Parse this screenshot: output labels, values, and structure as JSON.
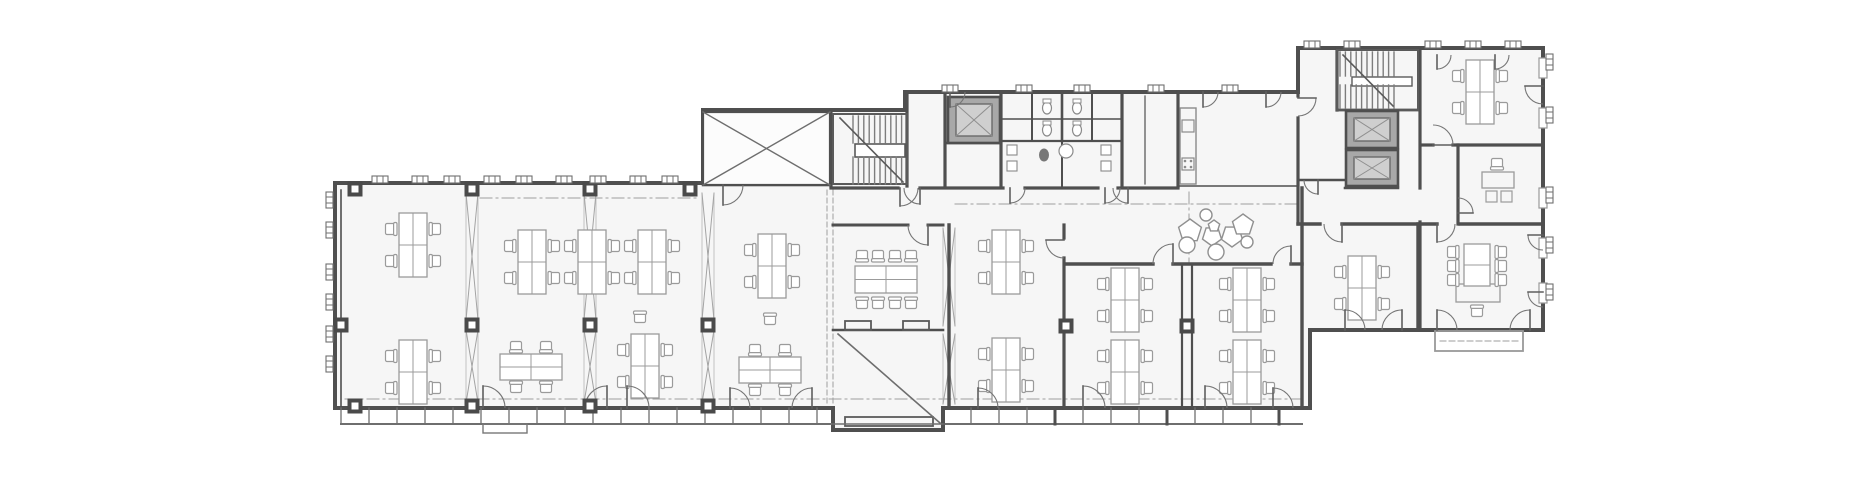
{
  "meta": {
    "kind": "architectural-floor-plan",
    "text_labels": []
  },
  "plan": {
    "canvas": {
      "w": 1872,
      "h": 479
    },
    "colors": {
      "bg": "#ffffff",
      "floor": "#f6f6f6",
      "wall": "#4f4f4f",
      "wallMid": "#6e6e6e",
      "thin": "#8a8a8a",
      "furn": "#9b9b9b",
      "furnLight": "#b5b5b5",
      "dash": "#9e9e9e",
      "tread": "#7d7d7d",
      "lift": "#a8a8a8",
      "liftCab": "#cfcfcf",
      "door": "#757575",
      "column": "#4a4a4a",
      "decor": "#909090"
    },
    "footprint": "M335,183 L703,183 L703,110 L905,110 L905,92 L1298,92 L1298,48 L1543,48 L1543,330 L1310,330 L1310,408 L943,408 L943,430 L833,430 L833,408 L335,408 Z",
    "walls": [
      [
        831,
        110,
        831,
        186,
        3.2
      ],
      [
        703,
        185,
        831,
        185,
        2.4
      ],
      [
        907,
        92,
        907,
        186,
        3.2
      ],
      [
        945,
        92,
        945,
        186,
        3.2
      ],
      [
        1001,
        92,
        1001,
        186,
        3.2
      ],
      [
        945,
        143,
        1001,
        143,
        2.4
      ],
      [
        831,
        188,
        898,
        188,
        3.2
      ],
      [
        920,
        188,
        1003,
        188,
        3.2
      ],
      [
        1025,
        188,
        1098,
        188,
        3.2
      ],
      [
        1118,
        188,
        1178,
        188,
        3.2
      ],
      [
        1003,
        141,
        1122,
        141,
        2.2
      ],
      [
        1003,
        119,
        1122,
        119,
        1.4
      ],
      [
        1032,
        92,
        1032,
        141,
        2
      ],
      [
        1062,
        92,
        1062,
        141,
        2.6
      ],
      [
        1092,
        92,
        1092,
        141,
        2
      ],
      [
        1062,
        141,
        1062,
        186,
        2
      ],
      [
        1122,
        92,
        1122,
        186,
        3.2
      ],
      [
        1145,
        96,
        1145,
        184,
        1.2
      ],
      [
        1178,
        92,
        1178,
        186,
        3.2
      ],
      [
        1178,
        186,
        1298,
        186,
        1.6
      ],
      [
        1298,
        92,
        1298,
        96,
        3.2
      ],
      [
        1298,
        118,
        1298,
        224,
        3.2
      ],
      [
        1337,
        48,
        1337,
        110,
        3.2
      ],
      [
        1337,
        110,
        1420,
        110,
        2.8
      ],
      [
        1420,
        48,
        1420,
        188,
        3.2
      ],
      [
        1420,
        222,
        1420,
        330,
        3.2
      ],
      [
        1300,
        180,
        1345,
        180,
        2.4
      ],
      [
        1345,
        188,
        1398,
        188,
        2.6
      ],
      [
        1423,
        145,
        1433,
        145,
        3.2
      ],
      [
        1453,
        145,
        1543,
        145,
        3.2
      ],
      [
        1458,
        145,
        1458,
        224,
        3.2
      ],
      [
        1298,
        224,
        1320,
        224,
        3.4
      ],
      [
        1342,
        224,
        1437,
        224,
        3.4
      ],
      [
        1460,
        224,
        1543,
        224,
        3.4
      ],
      [
        1418,
        224,
        1418,
        330,
        3.4
      ],
      [
        833,
        225,
        908,
        225,
        3
      ],
      [
        928,
        225,
        943,
        225,
        3
      ],
      [
        949,
        225,
        949,
        408,
        3.4
      ],
      [
        833,
        330,
        943,
        330,
        2.6
      ],
      [
        1064,
        225,
        1064,
        238,
        3.2
      ],
      [
        1064,
        258,
        1064,
        408,
        3.2
      ],
      [
        1066,
        264,
        1153,
        264,
        3.4
      ],
      [
        1173,
        264,
        1271,
        264,
        3.4
      ],
      [
        1291,
        264,
        1302,
        264,
        3.4
      ],
      [
        1182,
        264,
        1182,
        408,
        2.2
      ],
      [
        1192,
        264,
        1192,
        408,
        2.2
      ],
      [
        1302,
        188,
        1302,
        408,
        3.4
      ],
      [
        341,
        190,
        341,
        406,
        1.6
      ]
    ],
    "rects": [
      {
        "x": 703,
        "y": 112,
        "w": 127,
        "h": 73,
        "sw": 2.2,
        "stroke": "#4f4f4f",
        "fill": "#fcfcfc"
      },
      {
        "x": 1180,
        "y": 108,
        "w": 16,
        "h": 76,
        "sw": 1.4,
        "stroke": "#8a8a8a",
        "fill": "none"
      },
      {
        "x": 1182,
        "y": 120,
        "w": 12,
        "h": 12,
        "sw": 1.2,
        "stroke": "#8a8a8a",
        "fill": "none"
      },
      {
        "x": 1182,
        "y": 158,
        "w": 12,
        "h": 12,
        "sw": 1.2,
        "stroke": "#8a8a8a",
        "fill": "none"
      },
      {
        "x": 845,
        "y": 321,
        "w": 26,
        "h": 9,
        "sw": 1.8,
        "stroke": "#5a5a5a",
        "fill": "none"
      },
      {
        "x": 903,
        "y": 321,
        "w": 26,
        "h": 9,
        "sw": 1.8,
        "stroke": "#5a5a5a",
        "fill": "none"
      },
      {
        "x": 845,
        "y": 417,
        "w": 88,
        "h": 9,
        "sw": 1.8,
        "stroke": "#5a5a5a",
        "fill": "none"
      },
      {
        "x": 1435,
        "y": 331,
        "w": 88,
        "h": 20,
        "sw": 1.8,
        "stroke": "#999999",
        "fill": "none"
      },
      {
        "x": 1486,
        "y": 191,
        "w": 11,
        "h": 11,
        "sw": 1.2,
        "stroke": "#9b9b9b",
        "fill": "none"
      },
      {
        "x": 1501,
        "y": 191,
        "w": 11,
        "h": 11,
        "sw": 1.2,
        "stroke": "#9b9b9b",
        "fill": "none"
      },
      {
        "x": 483,
        "y": 424,
        "w": 44,
        "h": 9,
        "sw": 1.4,
        "stroke": "#777777",
        "fill": "none"
      },
      {
        "x": 855,
        "y": 144,
        "w": 50,
        "h": 13,
        "sw": 1.6,
        "stroke": "#5a5a5a",
        "fill": "#ffffff"
      },
      {
        "x": 1352,
        "y": 77,
        "w": 60,
        "h": 9,
        "sw": 1.4,
        "stroke": "#5a5a5a",
        "fill": "#ffffff"
      },
      {
        "x": 1482,
        "y": 172,
        "w": 32,
        "h": 16,
        "sw": 1.3,
        "stroke": "#9b9b9b",
        "fill": "none"
      },
      {
        "x": 1456,
        "y": 284,
        "w": 44,
        "h": 18,
        "sw": 1.3,
        "stroke": "#9b9b9b",
        "fill": "none"
      }
    ],
    "lines": [
      [
        703,
        112,
        830,
        185,
        1.4
      ],
      [
        703,
        185,
        830,
        112,
        1.4
      ],
      [
        838,
        334,
        940,
        423,
        1.6
      ],
      [
        833,
        424,
        943,
        424,
        1.6
      ]
    ],
    "dash_lines": [
      {
        "p": [
          480,
          198,
          700,
          198
        ],
        "d": "12 4 2 4",
        "sw": 1
      },
      {
        "p": [
          955,
          204,
          1296,
          204
        ],
        "d": "12 4 2 4",
        "sw": 1
      },
      {
        "p": [
          345,
          399,
          1300,
          399
        ],
        "d": "12 4 2 4",
        "sw": 1
      },
      {
        "p": [
          1189,
          192,
          1189,
          262
        ],
        "d": "12 4 2 4",
        "sw": 1
      },
      {
        "p": [
          827,
          190,
          827,
          406
        ],
        "d": "5 3",
        "sw": 1
      },
      {
        "p": [
          833,
          190,
          833,
          406
        ],
        "d": "5 3",
        "sw": 1
      },
      {
        "p": [
          1440,
          341,
          1518,
          341
        ],
        "d": "6 3",
        "sw": 1
      }
    ],
    "curtain_bands": [
      {
        "x1": 341,
        "x2": 831,
        "y": 408,
        "h": 16,
        "step": 28,
        "postEvery": 112,
        "postRef": 355
      },
      {
        "x1": 943,
        "x2": 1302,
        "y": 408,
        "h": 16,
        "step": 28,
        "postEvery": 112,
        "postRef": 943
      }
    ],
    "braces": [
      {
        "x": 472,
        "segs": [
          [
            193,
            320
          ],
          [
            330,
            403
          ]
        ]
      },
      {
        "x": 590,
        "segs": [
          [
            193,
            320
          ],
          [
            330,
            403
          ]
        ]
      },
      {
        "x": 708,
        "segs": [
          [
            193,
            320
          ],
          [
            330,
            403
          ]
        ]
      },
      {
        "x": 949,
        "segs": [
          [
            228,
            326
          ],
          [
            334,
            404
          ]
        ]
      }
    ],
    "columns": [
      [
        355,
        189
      ],
      [
        472,
        189
      ],
      [
        590,
        189
      ],
      [
        690,
        189
      ],
      [
        341,
        325
      ],
      [
        472,
        325
      ],
      [
        590,
        325
      ],
      [
        708,
        325
      ],
      [
        355,
        406
      ],
      [
        472,
        406
      ],
      [
        590,
        406
      ],
      [
        708,
        406
      ],
      [
        1066,
        326
      ],
      [
        1187,
        326
      ]
    ],
    "stairs": [
      {
        "frame": [
          833,
          114,
          74,
          70
        ],
        "tx0": 853,
        "tx1": 905,
        "top": [
          116,
          143
        ],
        "bot": [
          157,
          184
        ],
        "diag": [
          903,
          182,
          840,
          118
        ]
      },
      {
        "frame": [
          1337,
          50,
          81,
          60
        ],
        "tx0": 1340,
        "tx1": 1395,
        "top": [
          52,
          76
        ],
        "bot": [
          85,
          108
        ],
        "diag": [
          1393,
          106,
          1343,
          55
        ]
      }
    ],
    "elevators": [
      [
        948,
        97,
        52,
        46
      ],
      [
        1346,
        111,
        52,
        37
      ],
      [
        1346,
        150,
        52,
        36
      ]
    ],
    "desks_v": [
      [
        413,
        245
      ],
      [
        532,
        262
      ],
      [
        592,
        262
      ],
      [
        652,
        262
      ],
      [
        772,
        266
      ],
      [
        413,
        372
      ],
      [
        645,
        366
      ],
      [
        1006,
        262
      ],
      [
        1006,
        370
      ],
      [
        1125,
        300
      ],
      [
        1125,
        372
      ],
      [
        1247,
        300
      ],
      [
        1247,
        372
      ],
      [
        1480,
        92
      ],
      [
        1362,
        288
      ]
    ],
    "desks_h": [
      [
        531,
        367
      ],
      [
        770,
        370
      ]
    ],
    "single_chairs": [
      [
        640,
        318,
        0
      ],
      [
        770,
        320,
        0
      ],
      [
        1497,
        163,
        180
      ],
      [
        1477,
        312,
        0
      ]
    ],
    "meeting_table": {
      "x": 855,
      "y": 266,
      "w": 62,
      "h": 27,
      "top": [
        862,
        878,
        895,
        911
      ],
      "bottom": [
        862,
        878,
        895,
        911
      ],
      "chairYOff": 11
    },
    "v_table": {
      "x": 1464,
      "y": 244,
      "w": 26,
      "h": 42,
      "left": [
        252,
        266,
        280
      ],
      "right": [
        252,
        266,
        280
      ],
      "chairXOff": 12
    },
    "wc_ellipses": [
      [
        1047,
        108
      ],
      [
        1077,
        108
      ],
      [
        1047,
        130
      ],
      [
        1077,
        130
      ]
    ],
    "wc_dark": [
      1044,
      155
    ],
    "sink_circle": [
      1066,
      151,
      7
    ],
    "small_squares": [
      [
        1012,
        150
      ],
      [
        1012,
        166
      ],
      [
        1106,
        150
      ],
      [
        1106,
        166
      ]
    ],
    "stove_dots": [
      [
        1185,
        161
      ],
      [
        1191,
        161
      ],
      [
        1185,
        167
      ],
      [
        1191,
        167
      ]
    ],
    "pentagons": [
      [
        1190,
        231,
        12,
        0
      ],
      [
        1212,
        236,
        10,
        180
      ],
      [
        1232,
        236,
        11,
        180
      ],
      [
        1214,
        226,
        6,
        0
      ],
      [
        1243,
        225,
        11,
        0
      ]
    ],
    "decor_circles": [
      [
        1206,
        215,
        6
      ],
      [
        1187,
        245,
        8
      ],
      [
        1216,
        252,
        8
      ],
      [
        1247,
        242,
        6
      ]
    ],
    "doors": [
      [
        483,
        408,
        22,
        0,
        270,
        0
      ],
      [
        607,
        408,
        22,
        180,
        270,
        1
      ],
      [
        627,
        408,
        22,
        0,
        270,
        0
      ],
      [
        730,
        408,
        20,
        0,
        270,
        0
      ],
      [
        812,
        408,
        20,
        180,
        270,
        1
      ],
      [
        978,
        408,
        20,
        0,
        270,
        0
      ],
      [
        1083,
        408,
        22,
        0,
        270,
        0
      ],
      [
        1205,
        408,
        22,
        0,
        270,
        0
      ],
      [
        1273,
        408,
        20,
        0,
        270,
        0
      ],
      [
        1345,
        330,
        20,
        0,
        270,
        0
      ],
      [
        1402,
        330,
        20,
        180,
        270,
        1
      ],
      [
        1437,
        330,
        20,
        0,
        270,
        0
      ],
      [
        1530,
        330,
        20,
        180,
        270,
        1
      ],
      [
        723,
        185,
        20,
        0,
        90,
        1
      ],
      [
        900,
        188,
        18,
        0,
        90,
        1
      ],
      [
        920,
        188,
        16,
        180,
        90,
        0
      ],
      [
        1010,
        188,
        15,
        0,
        90,
        1
      ],
      [
        1105,
        188,
        15,
        0,
        90,
        1
      ],
      [
        1128,
        188,
        15,
        180,
        90,
        0
      ],
      [
        928,
        225,
        20,
        180,
        90,
        0
      ],
      [
        1064,
        240,
        18,
        90,
        180,
        1
      ],
      [
        1173,
        264,
        20,
        180,
        270,
        1
      ],
      [
        1291,
        264,
        18,
        180,
        270,
        1
      ],
      [
        1203,
        92,
        15,
        0,
        90,
        1
      ],
      [
        1266,
        92,
        15,
        0,
        90,
        1
      ],
      [
        950,
        92,
        15,
        0,
        90,
        1
      ],
      [
        1298,
        98,
        18,
        90,
        0,
        0
      ],
      [
        1318,
        180,
        14,
        180,
        90,
        0
      ],
      [
        1433,
        145,
        20,
        270,
        0,
        1
      ],
      [
        1543,
        86,
        18,
        90,
        180,
        1
      ],
      [
        1458,
        213,
        15,
        270,
        0,
        1
      ],
      [
        1543,
        235,
        15,
        90,
        180,
        1
      ],
      [
        1543,
        292,
        15,
        90,
        180,
        1
      ],
      [
        1342,
        224,
        18,
        180,
        90,
        0
      ],
      [
        1437,
        224,
        18,
        0,
        90,
        1
      ],
      [
        1437,
        55,
        14,
        0,
        90,
        1
      ],
      [
        1495,
        55,
        14,
        0,
        90,
        1
      ]
    ],
    "sills_h": [
      {
        "y": 176,
        "xs": [
          380,
          420,
          452,
          492,
          524,
          564,
          598,
          638,
          670
        ]
      },
      {
        "y": 85,
        "xs": [
          950,
          1024,
          1082,
          1156,
          1230
        ]
      },
      {
        "y": 41,
        "xs": [
          1312,
          1352,
          1433,
          1473,
          1513
        ]
      }
    ],
    "sills_v": [
      {
        "x": 326,
        "ys": [
          200,
          230,
          272,
          302,
          334,
          364
        ]
      },
      {
        "x": 1546,
        "ys": [
          62,
          115,
          195,
          245,
          292
        ]
      }
    ],
    "right_windows": {
      "x": 1539,
      "w": 8,
      "h": 20,
      "ys": [
        58,
        108,
        188,
        238,
        283
      ]
    }
  }
}
